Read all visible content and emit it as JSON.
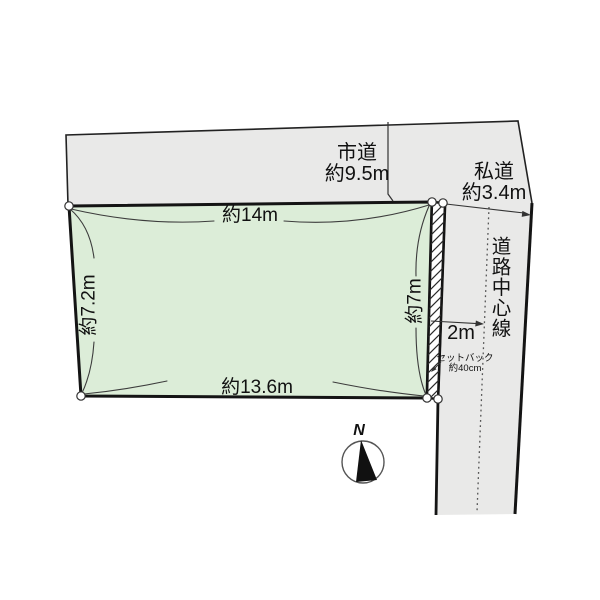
{
  "colors": {
    "road_fill": "#e9e9e8",
    "parcel_fill": "#dcedd8",
    "outline": "#1a1a1a"
  },
  "roads": {
    "city": {
      "name": "市道",
      "width": "約9.5m"
    },
    "private": {
      "name": "私道",
      "width": "約3.4m"
    },
    "center_line_label": "道路中心線",
    "center_offset": "2m"
  },
  "parcel": {
    "dim_top": "約14m",
    "dim_bottom": "約13.6m",
    "dim_left": "約7.2m",
    "dim_right": "約7m"
  },
  "setback": {
    "line1": "セットバック",
    "line2": "約40cm"
  },
  "compass": {
    "north": "N"
  }
}
